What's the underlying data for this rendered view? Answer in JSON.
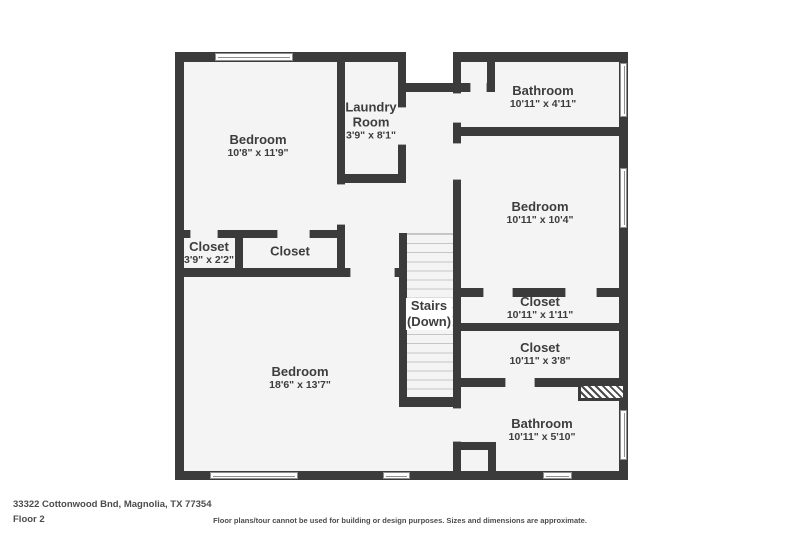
{
  "plan_title": "Floor plan",
  "colors": {
    "wall": "#3b3b3b",
    "floor": "#f4f4f4",
    "background": "#ffffff"
  },
  "rooms": [
    {
      "id": "bedroom-top-left",
      "name": "Bedroom",
      "dims": "10'8\" x 11'9\""
    },
    {
      "id": "laundry-room",
      "name": "Laundry Room",
      "dims": "3'9\" x 8'1\""
    },
    {
      "id": "bathroom-top",
      "name": "Bathroom",
      "dims": "10'11\" x 4'11\""
    },
    {
      "id": "bedroom-right",
      "name": "Bedroom",
      "dims": "10'11\" x 10'4\""
    },
    {
      "id": "closet-small",
      "name": "Closet",
      "dims": "3'9\" x 2'2\""
    },
    {
      "id": "closet-mid",
      "name": "Closet",
      "dims": ""
    },
    {
      "id": "stairs",
      "name": "Stairs",
      "dims": "(Down)"
    },
    {
      "id": "closet-hall-1",
      "name": "Closet",
      "dims": "10'11\" x 1'11\""
    },
    {
      "id": "closet-hall-2",
      "name": "Closet",
      "dims": "10'11\" x 3'8\""
    },
    {
      "id": "bedroom-large",
      "name": "Bedroom",
      "dims": "18'6\" x 13'7\""
    },
    {
      "id": "bathroom-bottom",
      "name": "Bathroom",
      "dims": "10'11\" x 5'10\""
    }
  ],
  "footer": {
    "address": "33322 Cottonwood Bnd, Magnolia, TX 77354",
    "floor_label": "Floor 2",
    "disclaimer": "Floor plans/tour cannot be used for building or design purposes. Sizes and dimensions are approximate."
  }
}
